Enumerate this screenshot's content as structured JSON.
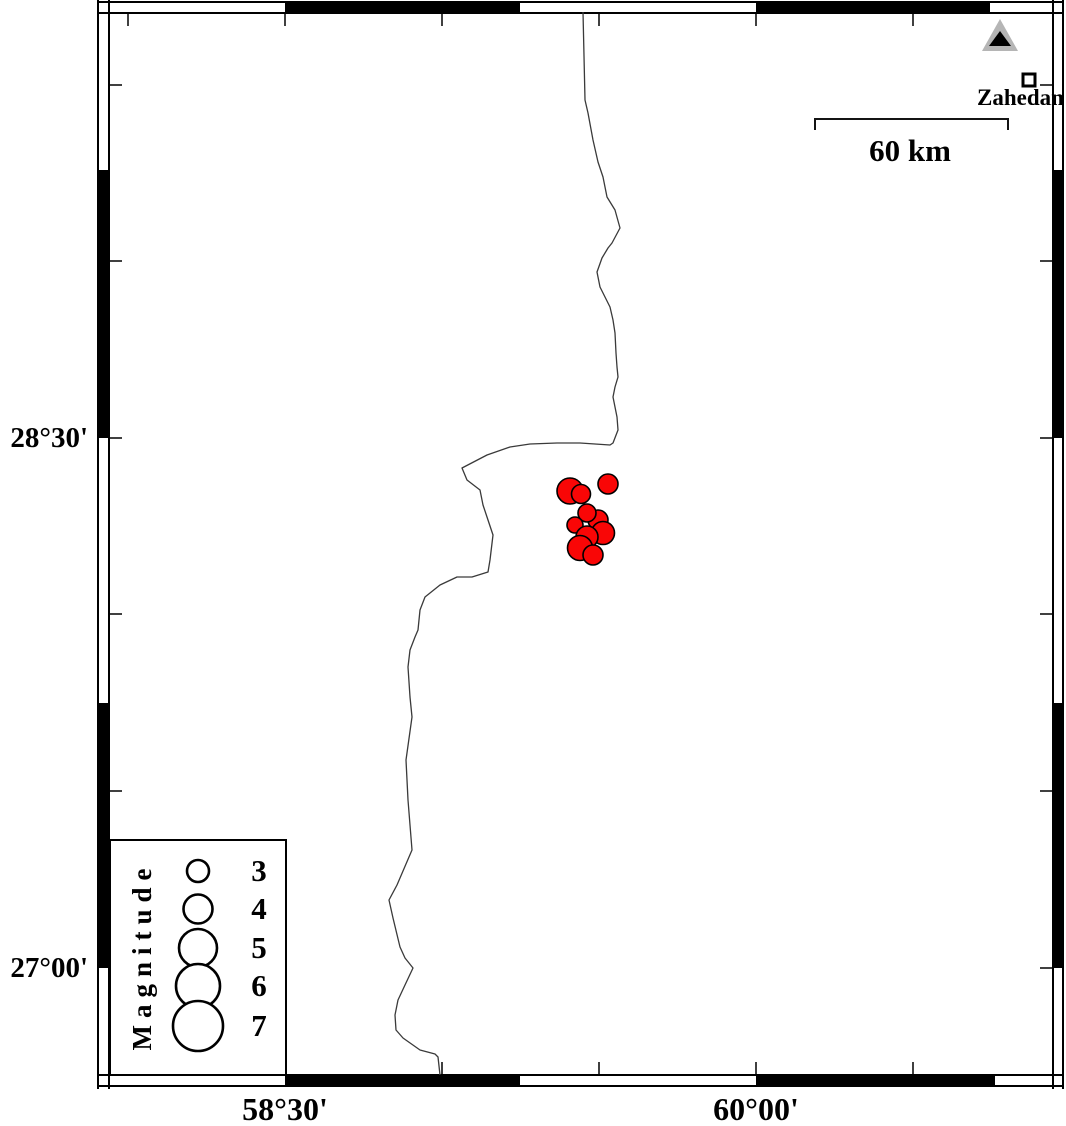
{
  "map": {
    "region_bounds_estimate": {
      "west_lon": 57.94,
      "east_lon": 60.95,
      "south_lat": 26.7,
      "north_lat": 29.7
    },
    "axis": {
      "left": [
        {
          "label": "28°30'",
          "y_px": 438,
          "lat": 28.5
        },
        {
          "label": "27°00'",
          "y_px": 968,
          "lat": 27.0
        }
      ],
      "bottom": [
        {
          "label": "58°30'",
          "x_px": 285,
          "lon": 58.5
        },
        {
          "label": "60°00'",
          "x_px": 756,
          "lon": 60.0
        }
      ]
    },
    "frame": {
      "outer": {
        "x1": 98,
        "y1": 2,
        "x2": 1063,
        "y2": 1086
      },
      "inner": {
        "x1": 109,
        "y1": 13,
        "x2": 1053,
        "y2": 1075
      },
      "black_segments": {
        "top_x": [
          [
            285,
            520
          ],
          [
            756,
            990
          ]
        ],
        "bottom_x": [
          [
            285,
            520
          ],
          [
            756,
            995
          ]
        ],
        "left_y": [
          [
            170,
            438
          ],
          [
            703,
            968
          ]
        ],
        "right_y": [
          [
            170,
            438
          ],
          [
            703,
            968
          ]
        ]
      },
      "ticks": {
        "top_x": [
          128,
          285,
          442,
          599,
          756,
          913
        ],
        "bottom_x": [
          128,
          285,
          442,
          599,
          756,
          913
        ],
        "left_y": [
          85,
          261,
          438,
          614,
          791,
          968
        ],
        "right_y": [
          85,
          261,
          438,
          614,
          791,
          968
        ],
        "length": 13
      }
    },
    "scale_bar": {
      "label": "60 km",
      "x1": 815,
      "x2": 1008,
      "y": 119,
      "drop": 11
    },
    "city": {
      "name": "Zahedan",
      "square": {
        "x": 1023,
        "y": 74,
        "size": 12
      }
    },
    "volcano_triangle": {
      "outer": [
        [
          982,
          51
        ],
        [
          1018,
          51
        ],
        [
          1000,
          19
        ]
      ],
      "inner": [
        [
          989,
          46
        ],
        [
          1011,
          46
        ],
        [
          1000,
          31
        ]
      ]
    },
    "legend": {
      "title": "Magnitude",
      "box": {
        "x": 110,
        "y": 840,
        "w": 176,
        "h": 235
      },
      "circle_cx": 198,
      "entries": [
        {
          "label": "3",
          "cy": 871,
          "r": 11
        },
        {
          "label": "4",
          "cy": 909,
          "r": 14.5
        },
        {
          "label": "5",
          "cy": 948,
          "r": 19
        },
        {
          "label": "6",
          "cy": 986,
          "r": 22
        },
        {
          "label": "7",
          "cy": 1026,
          "r": 25
        }
      ]
    },
    "earthquakes": [
      {
        "x": 608,
        "y": 484,
        "r": 10,
        "lon_est": 59.53,
        "lat_est": 28.37,
        "mag_est": 2.7
      },
      {
        "x": 570,
        "y": 491,
        "r": 13,
        "lon_est": 59.41,
        "lat_est": 28.35,
        "mag_est": 3.6
      },
      {
        "x": 581,
        "y": 494,
        "r": 9.5,
        "lon_est": 59.44,
        "lat_est": 28.34,
        "mag_est": 2.6
      },
      {
        "x": 598,
        "y": 520,
        "r": 10,
        "lon_est": 59.5,
        "lat_est": 28.27,
        "mag_est": 2.7
      },
      {
        "x": 587,
        "y": 513,
        "r": 9,
        "lon_est": 59.46,
        "lat_est": 28.29,
        "mag_est": 2.4
      },
      {
        "x": 575,
        "y": 525,
        "r": 8,
        "lon_est": 59.42,
        "lat_est": 28.25,
        "mag_est": 2.2
      },
      {
        "x": 603,
        "y": 533,
        "r": 11.5,
        "lon_est": 59.51,
        "lat_est": 28.23,
        "mag_est": 3.1
      },
      {
        "x": 587,
        "y": 537,
        "r": 11,
        "lon_est": 59.46,
        "lat_est": 28.22,
        "mag_est": 3.0
      },
      {
        "x": 580,
        "y": 548,
        "r": 12.5,
        "lon_est": 59.44,
        "lat_est": 28.19,
        "mag_est": 3.4
      },
      {
        "x": 593,
        "y": 555,
        "r": 10,
        "lon_est": 59.48,
        "lat_est": 28.17,
        "mag_est": 2.7
      }
    ],
    "coastline": [
      [
        583,
        12
      ],
      [
        585,
        100
      ],
      [
        588,
        113
      ],
      [
        593,
        140
      ],
      [
        598,
        162
      ],
      [
        603,
        177
      ],
      [
        607,
        197
      ],
      [
        615,
        210
      ],
      [
        620,
        228
      ],
      [
        612,
        243
      ],
      [
        608,
        248
      ],
      [
        602,
        258
      ],
      [
        597,
        272
      ],
      [
        600,
        287
      ],
      [
        605,
        297
      ],
      [
        610,
        307
      ],
      [
        613,
        320
      ],
      [
        615,
        333
      ],
      [
        616,
        353
      ],
      [
        617,
        367
      ],
      [
        618,
        377
      ],
      [
        615,
        387
      ],
      [
        613,
        397
      ],
      [
        617,
        417
      ],
      [
        618,
        430
      ],
      [
        613,
        443
      ],
      [
        610,
        445
      ],
      [
        580,
        443
      ],
      [
        557,
        443
      ],
      [
        530,
        444
      ],
      [
        510,
        447
      ],
      [
        487,
        455
      ],
      [
        462,
        468
      ],
      [
        467,
        480
      ],
      [
        480,
        490
      ],
      [
        483,
        505
      ],
      [
        488,
        520
      ],
      [
        493,
        535
      ],
      [
        490,
        560
      ],
      [
        488,
        572
      ],
      [
        472,
        577
      ],
      [
        457,
        577
      ],
      [
        440,
        585
      ],
      [
        425,
        597
      ],
      [
        420,
        610
      ],
      [
        418,
        630
      ],
      [
        415,
        637
      ],
      [
        410,
        650
      ],
      [
        408,
        667
      ],
      [
        410,
        697
      ],
      [
        412,
        717
      ],
      [
        406,
        760
      ],
      [
        408,
        800
      ],
      [
        412,
        850
      ],
      [
        397,
        885
      ],
      [
        389,
        900
      ],
      [
        393,
        918
      ],
      [
        400,
        947
      ],
      [
        405,
        958
      ],
      [
        413,
        968
      ],
      [
        405,
        985
      ],
      [
        398,
        1000
      ],
      [
        395,
        1015
      ],
      [
        396,
        1030
      ],
      [
        403,
        1038
      ],
      [
        420,
        1050
      ],
      [
        435,
        1054
      ],
      [
        438,
        1057
      ],
      [
        440,
        1075
      ]
    ]
  },
  "colors": {
    "background": "#ffffff",
    "epicenter_fill": "#f90606",
    "outline": "#000000",
    "coastline": "#3a3a3a",
    "volcano_gray": "#b5b5b5"
  }
}
